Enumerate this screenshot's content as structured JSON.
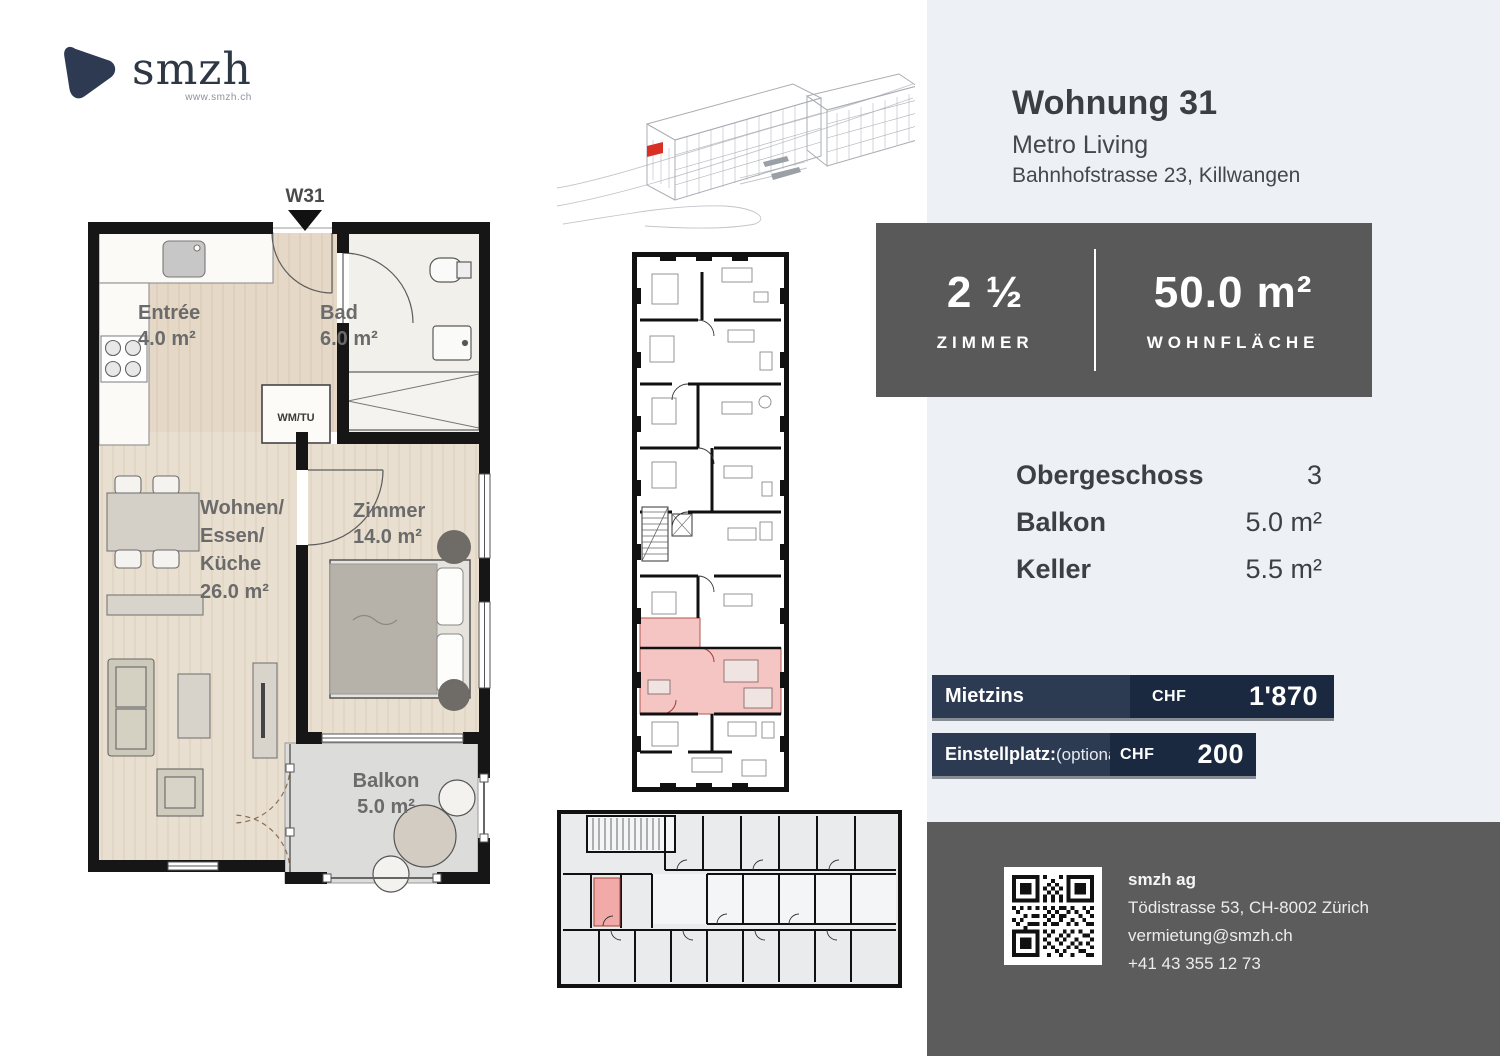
{
  "logo": {
    "name": "smzh",
    "website": "www.smzh.ch"
  },
  "unit_plan": {
    "marker": "W31",
    "rooms": [
      {
        "label": "Entrée\n4.0 m²"
      },
      {
        "label": "Bad\n6.0 m²"
      },
      {
        "label": "Wohnen/\nEssen/\nKüche\n26.0 m²"
      },
      {
        "label": "Zimmer\n14.0 m²"
      },
      {
        "label": "Balkon\n5.0 m²"
      }
    ],
    "appliance_label": "WM/TU"
  },
  "header": {
    "title": "Wohnung 31",
    "project": "Metro Living",
    "address": "Bahnhofstrasse 23, Killwangen"
  },
  "stats": {
    "rooms": {
      "value": "2 ½",
      "label": "ZIMMER"
    },
    "area": {
      "value": "50.0 m²",
      "label": "WOHNFLÄCHE"
    }
  },
  "details": {
    "rows": [
      {
        "label": "Obergeschoss",
        "value": "3"
      },
      {
        "label": "Balkon",
        "value": "5.0 m²"
      },
      {
        "label": "Keller",
        "value": "5.5 m²"
      }
    ]
  },
  "pricing": {
    "rows": [
      {
        "label": "Mietzins",
        "note": "",
        "currency": "CHF",
        "amount": "1'870"
      },
      {
        "label": "Einstellplatz:",
        "note": "(optional)",
        "currency": "CHF",
        "amount": "200"
      }
    ]
  },
  "footer": {
    "company": "smzh ag",
    "address": "Tödistrasse 53, CH-8002 Zürich",
    "email": "vermietung@smzh.ch",
    "phone": "+41 43 355 12 73"
  },
  "colors": {
    "brand_navy": "#2c3a52",
    "price_bar_dark": "#1b2940",
    "stats_card_gray": "#595959",
    "panel_blue": "#edf1f6",
    "footer_gray": "#5c5c5c",
    "highlight_red": "#d93025",
    "highlight_pink": "#f5c5c3"
  }
}
